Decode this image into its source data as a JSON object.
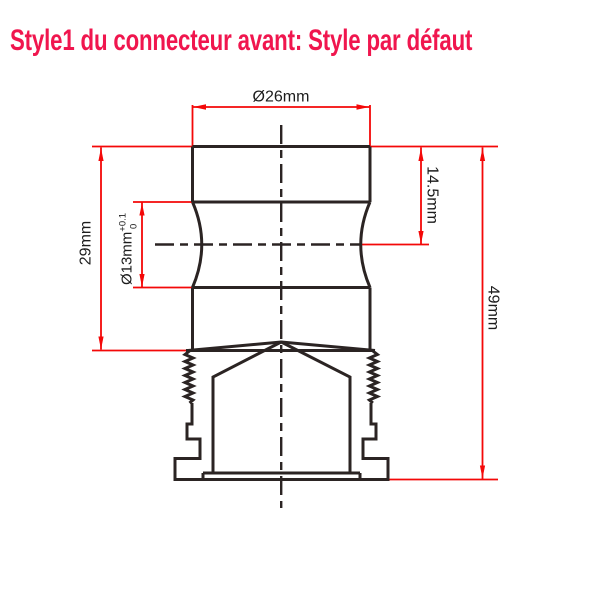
{
  "title": {
    "text": "Style1 du connecteur avant: Style par défaut",
    "color": "#F0164E"
  },
  "drawing": {
    "type": "technical-dimension-drawing",
    "subject": "front connector profile",
    "colors": {
      "outline": "#2B2423",
      "dimension_lines": "#F40808",
      "dimension_text": "#1C1C1C",
      "background": "#FFFFFF"
    },
    "dimensions": {
      "top_diameter": "Ø26mm",
      "overall_left_height": "29mm",
      "waist_diameter": "Ø13mm",
      "waist_tolerance_upper": "+0.1",
      "waist_tolerance_lower": "0",
      "upper_right_height": "14.5mm",
      "overall_right_height": "49mm"
    }
  }
}
